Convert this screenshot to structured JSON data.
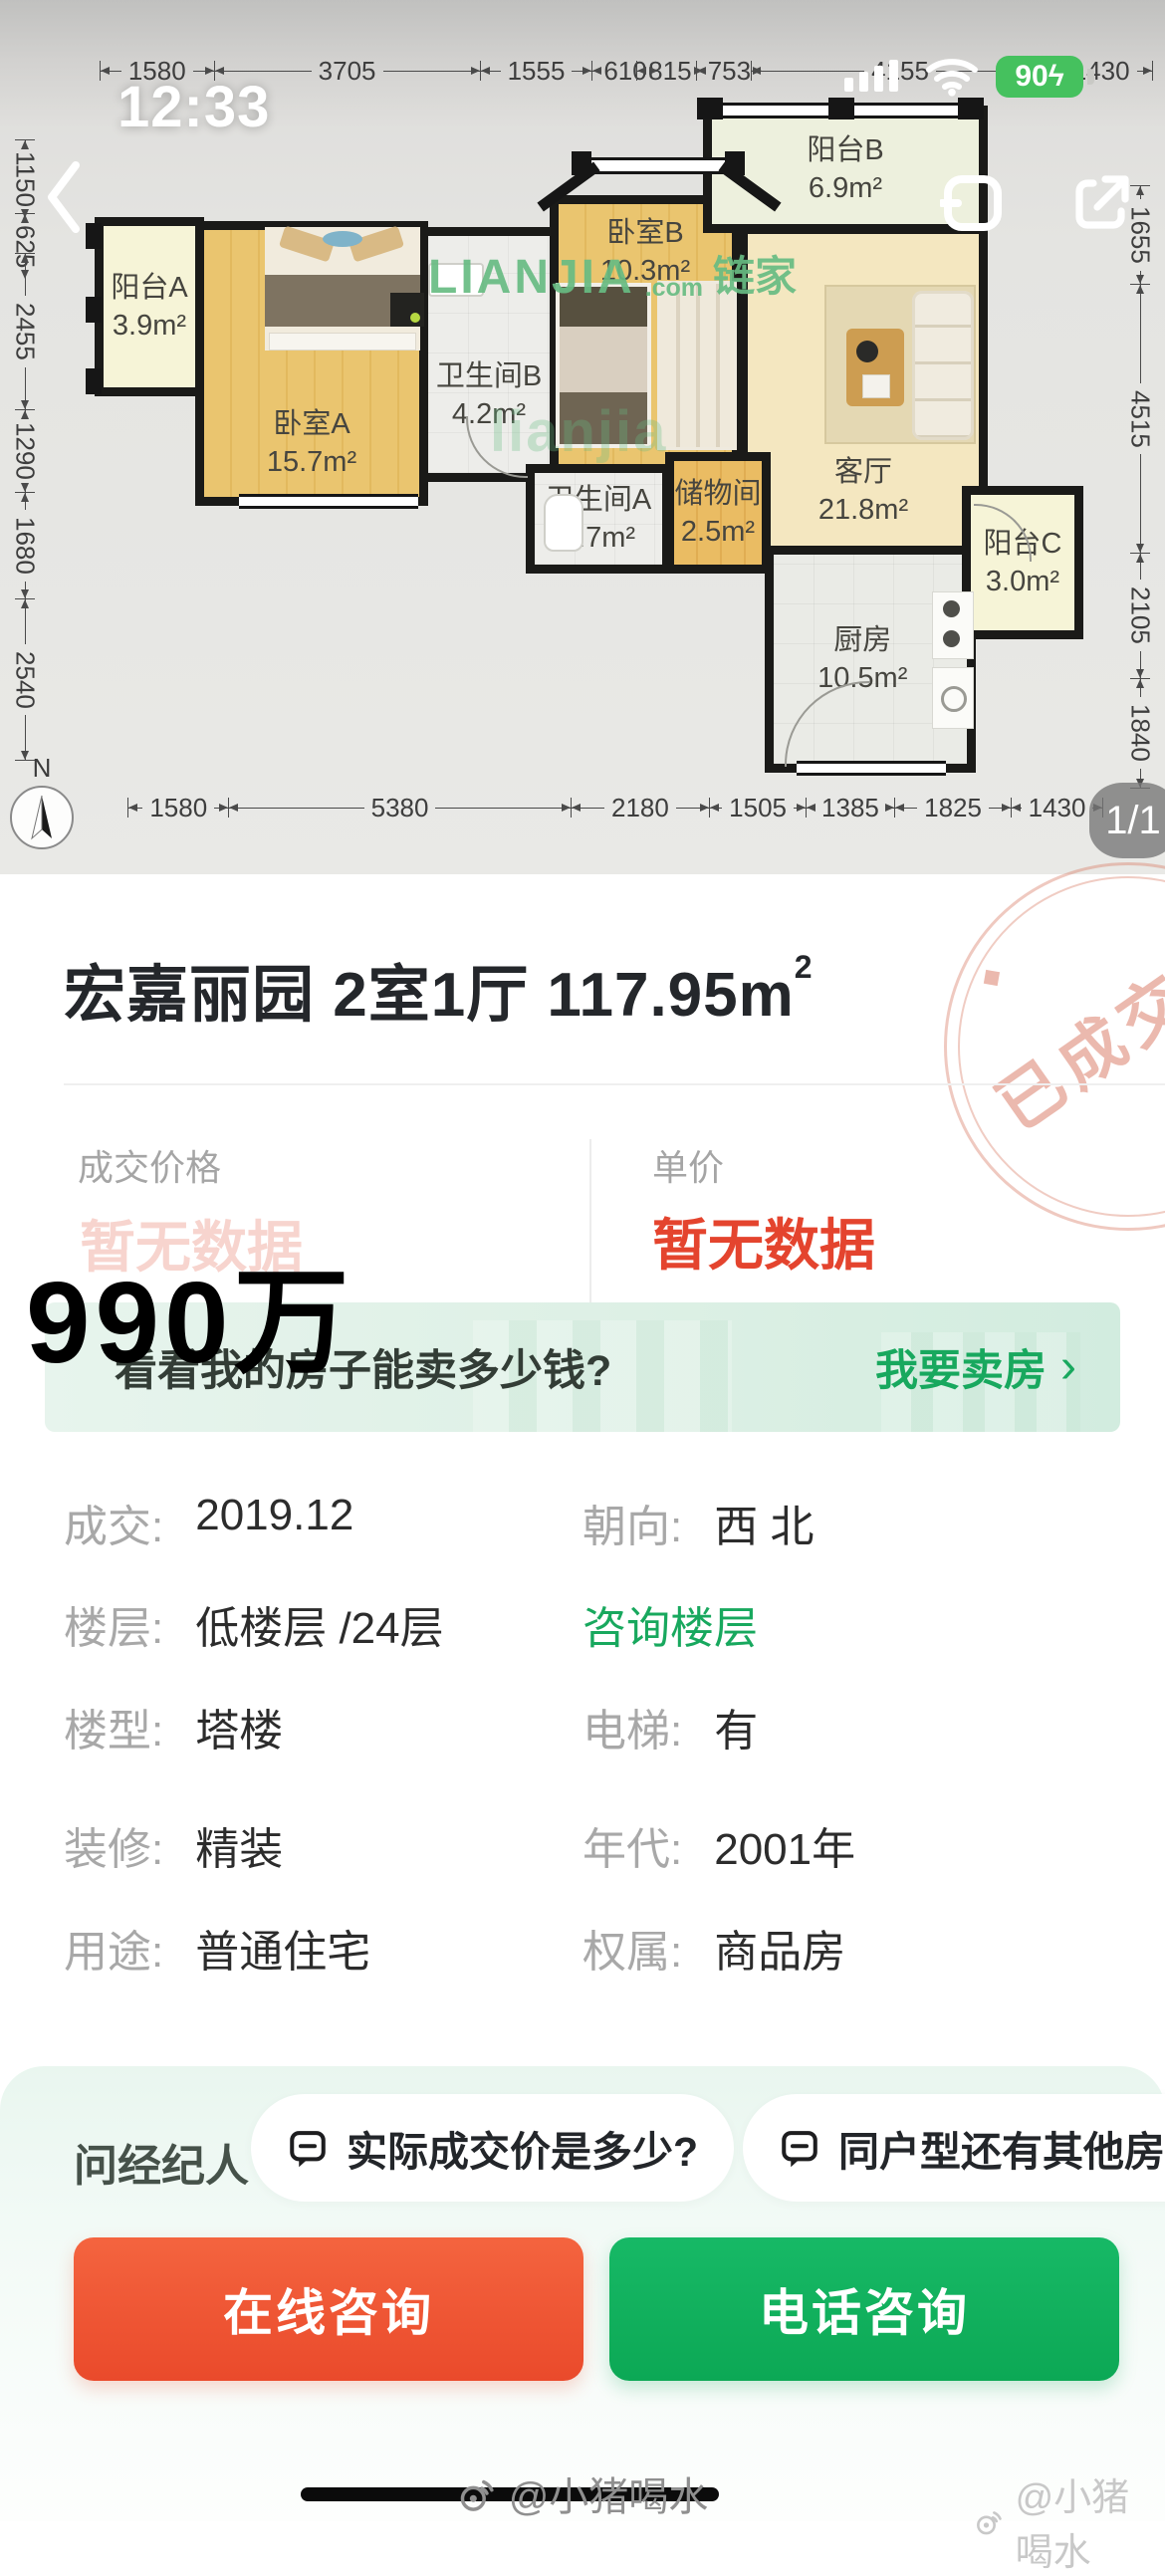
{
  "status_bar": {
    "time": "12:33",
    "battery_percent": "90",
    "battery_bolt": "ϟ"
  },
  "plan": {
    "dims_top": [
      1580,
      3705,
      1555,
      610,
      815,
      753,
      4155,
      1430
    ],
    "dims_bottom": [
      1580,
      5380,
      2180,
      1505,
      1385,
      1825,
      1430
    ],
    "dims_left": [
      1150,
      625,
      2455,
      1290,
      1680,
      2540
    ],
    "dims_right": [
      1655,
      4515,
      2105,
      1840
    ],
    "north_label": "N",
    "page_badge": "1/1",
    "rooms": [
      {
        "name": "阳台A",
        "area": "3.9m²"
      },
      {
        "name": "卧室A",
        "area": "15.7m²"
      },
      {
        "name": "卫生间B",
        "area": "4.2m²"
      },
      {
        "name": "卧室B",
        "area": "10.3m²"
      },
      {
        "name": "阳台B",
        "area": "6.9m²"
      },
      {
        "name": "客厅",
        "area": "21.8m²"
      },
      {
        "name": "卫生间A",
        "area": "3.7m²"
      },
      {
        "name": "储物间",
        "area": "2.5m²"
      },
      {
        "name": "厨房",
        "area": "10.5m²"
      },
      {
        "name": "阳台C",
        "area": "3.0m²"
      }
    ],
    "watermark": {
      "brand": "LIANJIA",
      "tld": ".com",
      "cn": "链家",
      "faint": "lianjia"
    }
  },
  "listing": {
    "title_main": "宏嘉丽园 2室1厅 117.95m",
    "title_sup": "2",
    "stamp": "已成交",
    "price_label": "成交价格",
    "price_value": "暂无数据",
    "unit_label": "单价",
    "unit_value": "暂无数据",
    "overlay_price": "990万",
    "banner": {
      "question": "看看我的房子能卖多少钱?",
      "action": "我要卖房",
      "chevron": "›"
    },
    "details": [
      {
        "label": "成交:",
        "value": "2019.12"
      },
      {
        "label": "朝向:",
        "value": "西 北"
      },
      {
        "label": "楼层:",
        "value": "低楼层 /24层"
      },
      {
        "label": "",
        "value": "咨询楼层"
      },
      {
        "label": "楼型:",
        "value": "塔楼"
      },
      {
        "label": "电梯:",
        "value": "有"
      },
      {
        "label": "装修:",
        "value": "精装"
      },
      {
        "label": "年代:",
        "value": "2001年"
      },
      {
        "label": "用途:",
        "value": "普通住宅"
      },
      {
        "label": "权属:",
        "value": "商品房"
      }
    ]
  },
  "bottom_sheet": {
    "ask_label": "问经纪人",
    "chips": [
      "实际成交价是多少?",
      "同户型还有其他房源"
    ],
    "online_button": "在线咨询",
    "phone_button": "电话咨询"
  },
  "watermark_center": "@小猪喝水",
  "watermark_right": "@小猪喝水",
  "colors": {
    "brand_green": "#18a85e",
    "alert_red": "#e4442e",
    "online_btn_orange": "#ee5434",
    "phone_btn_green": "#10b05e",
    "battery_green": "#45c15e",
    "watermark_green": "#68bc83",
    "stamp_pink": "#d86c56"
  }
}
